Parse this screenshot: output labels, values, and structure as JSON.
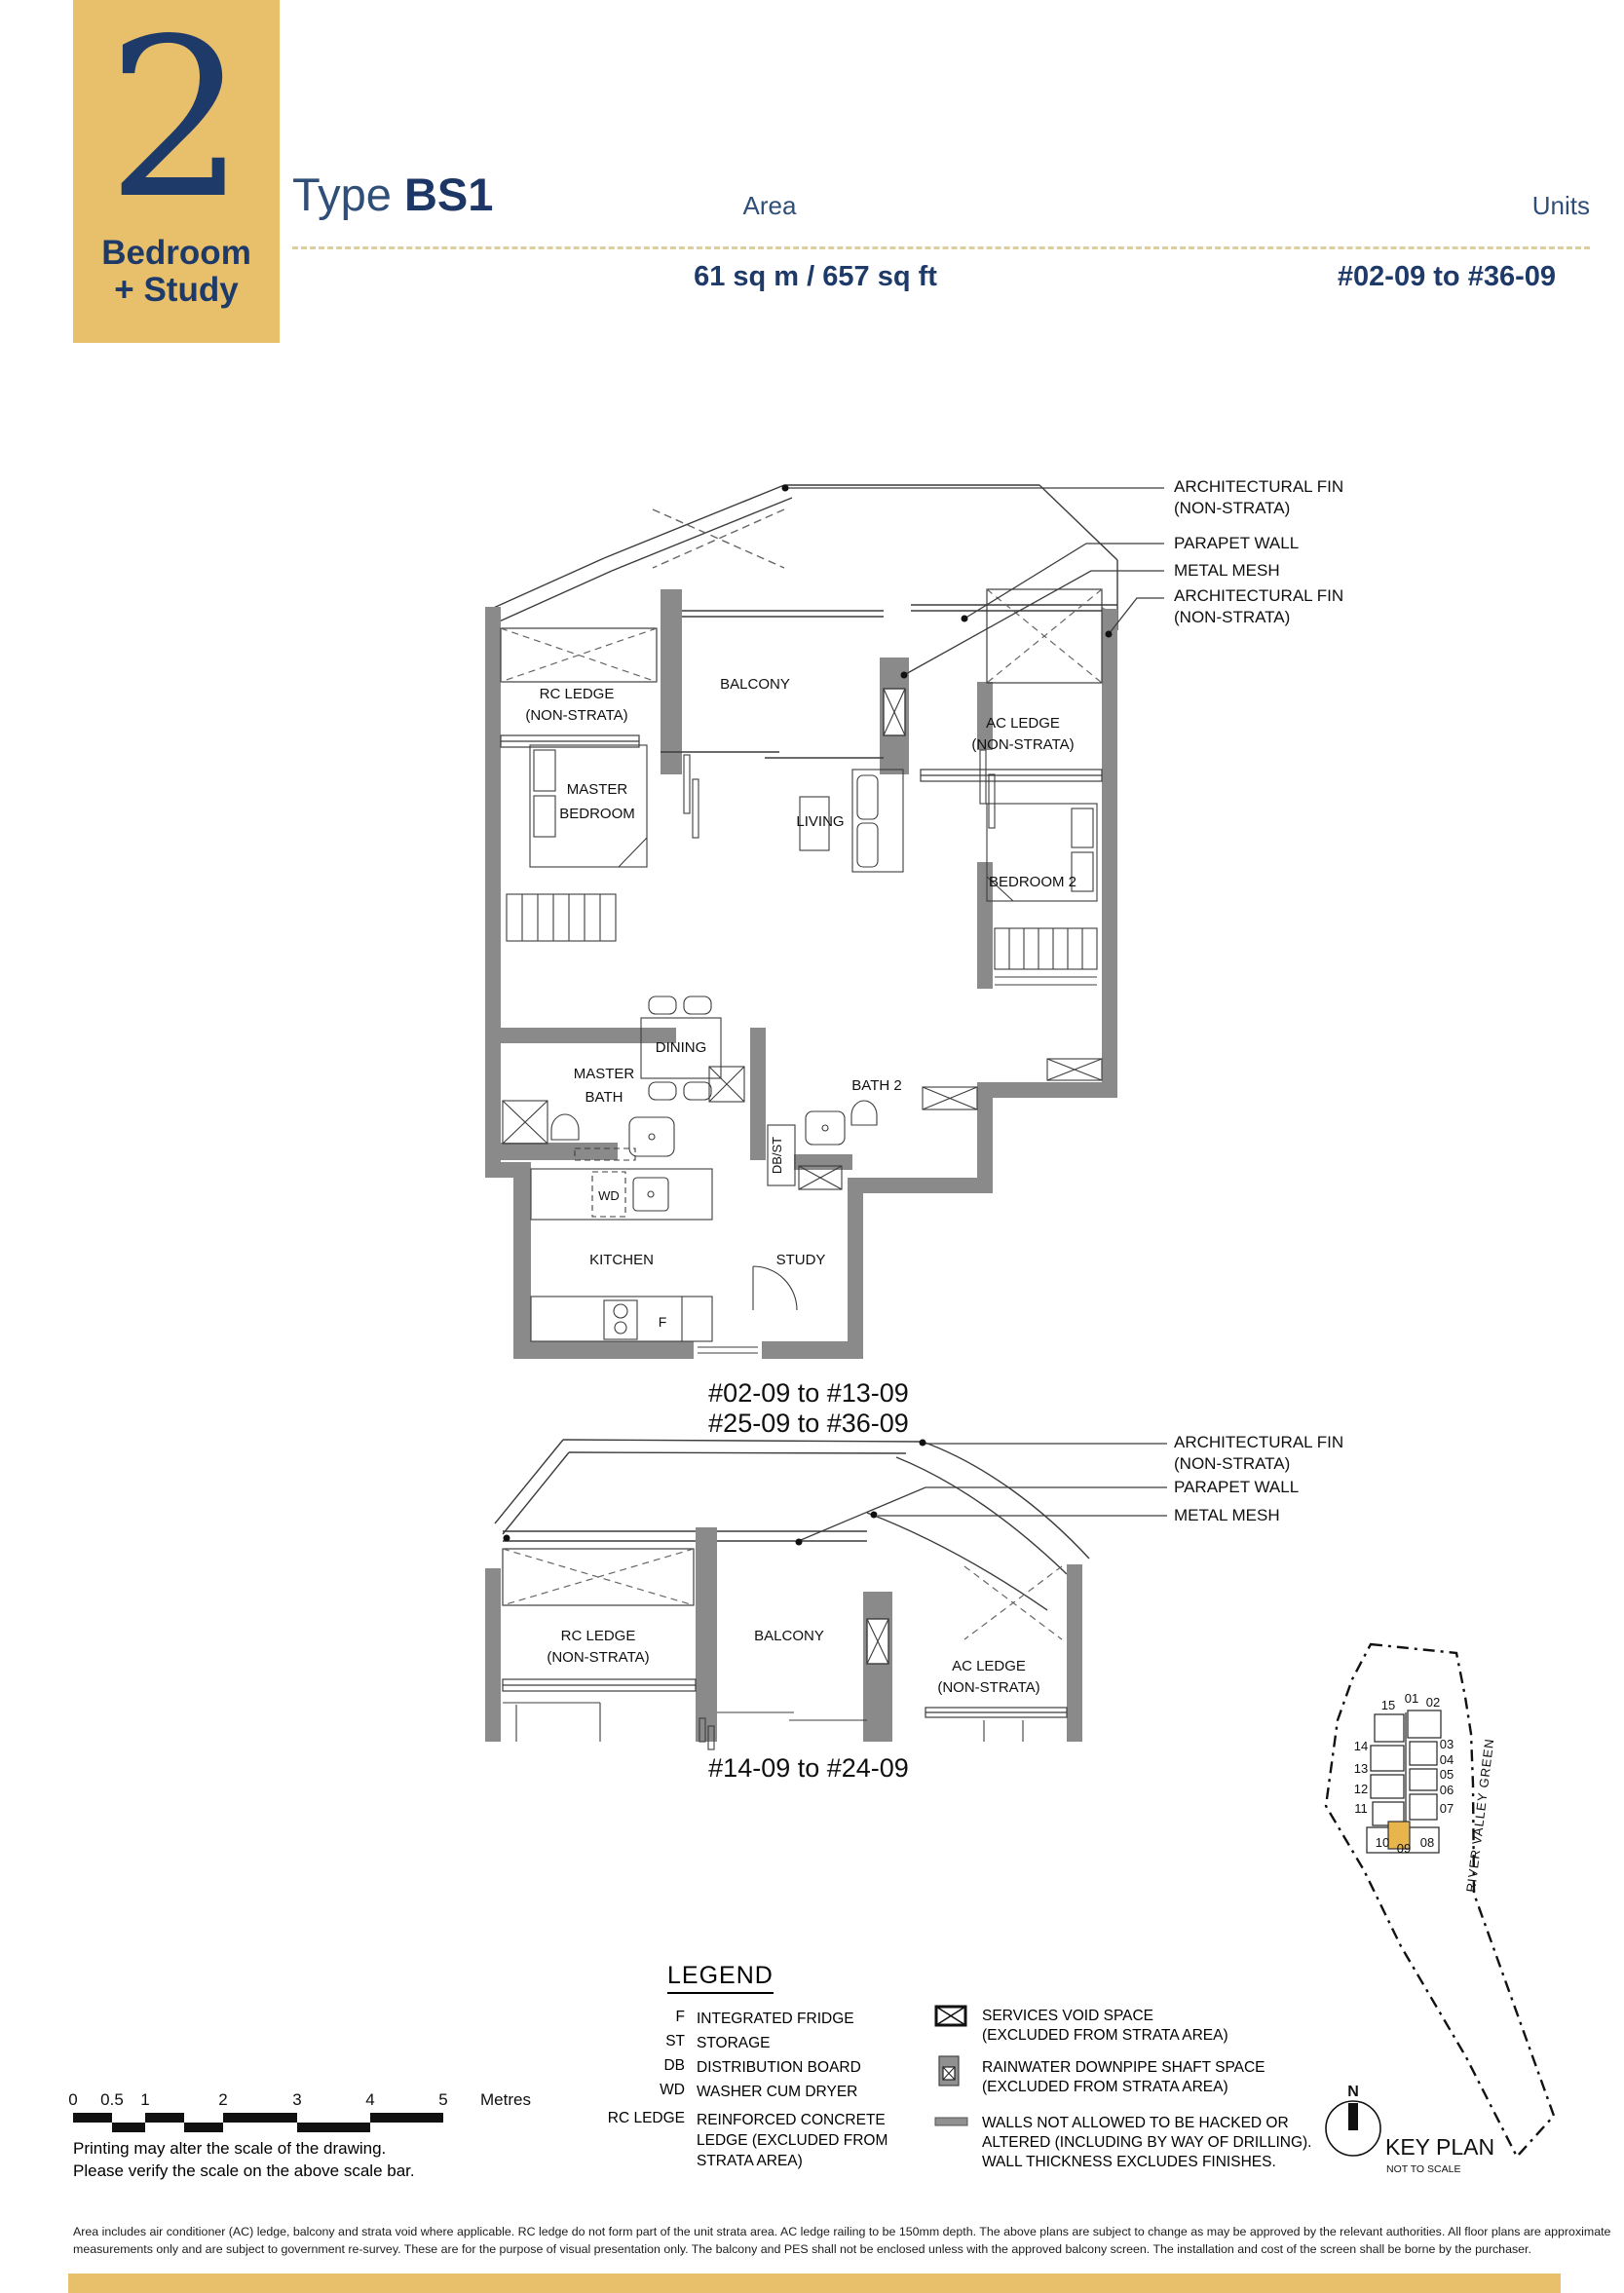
{
  "header": {
    "badge_number": "2",
    "badge_line1": "Bedroom",
    "badge_line2": "+ Study",
    "type_label": "Type ",
    "type_code": "BS1",
    "area_label": "Area",
    "units_label": "Units",
    "area_value": "61 sq m / 657 sq ft",
    "units_value": "#02-09 to #36-09"
  },
  "plan1": {
    "labels": {
      "rc_a": "RC LEDGE",
      "rc_b": "(NON-STRATA)",
      "balcony": "BALCONY",
      "ac_a": "AC LEDGE",
      "ac_b": "(NON-STRATA)",
      "mb_a": "MASTER",
      "mb_b": "BEDROOM",
      "living": "LIVING",
      "b2": "BEDROOM 2",
      "mbath_a": "MASTER",
      "mbath_b": "BATH",
      "dining": "DINING",
      "bath2": "BATH 2",
      "dbst": "DB/ST",
      "wd": "WD",
      "kitchen": "KITCHEN",
      "study": "STUDY",
      "f": "F"
    },
    "caption_line1": "#02-09 to #13-09",
    "caption_line2": "#25-09 to #36-09",
    "callouts": {
      "fin_a": "ARCHITECTURAL FIN",
      "fin_b": "(NON-STRATA)",
      "parapet": "PARAPET WALL",
      "mesh": "METAL MESH",
      "fin2_a": "ARCHITECTURAL FIN",
      "fin2_b": "(NON-STRATA)"
    }
  },
  "plan2": {
    "labels": {
      "rc_a": "RC LEDGE",
      "rc_b": "(NON-STRATA)",
      "balcony": "BALCONY",
      "ac_a": "AC LEDGE",
      "ac_b": "(NON-STRATA)"
    },
    "caption": "#14-09 to #24-09",
    "callouts": {
      "fin_a": "ARCHITECTURAL FIN",
      "fin_b": "(NON-STRATA)",
      "parapet": "PARAPET WALL",
      "mesh": "METAL MESH"
    }
  },
  "keyplan": {
    "units": [
      "15",
      "01",
      "02",
      "14",
      "03",
      "13",
      "04",
      "05",
      "12",
      "06",
      "11",
      "07",
      "10",
      "09",
      "08"
    ],
    "highlighted_unit": "09",
    "road": "RIVER VALLEY GREEN",
    "north": "N",
    "title": "KEY PLAN",
    "subtitle": "NOT TO SCALE"
  },
  "legend": {
    "title": "LEGEND",
    "left": [
      {
        "key": "F",
        "desc": "INTEGRATED FRIDGE"
      },
      {
        "key": "ST",
        "desc": "STORAGE"
      },
      {
        "key": "DB",
        "desc": "DISTRIBUTION BOARD"
      },
      {
        "key": "WD",
        "desc": "WASHER CUM DRYER"
      },
      {
        "key": "RC LEDGE",
        "desc1": "REINFORCED CONCRETE",
        "desc2": "LEDGE (EXCLUDED FROM",
        "desc3": "STRATA AREA)"
      }
    ],
    "right": [
      {
        "icon": "services-void-icon",
        "l1": "SERVICES VOID SPACE",
        "l2": "(EXCLUDED FROM STRATA AREA)"
      },
      {
        "icon": "rainwater-downpipe-icon",
        "l1": "RAINWATER DOWNPIPE SHAFT SPACE",
        "l2": "(EXCLUDED FROM STRATA AREA)"
      },
      {
        "icon": "protected-wall-icon",
        "l1": "WALLS NOT ALLOWED TO BE HACKED OR",
        "l2": "ALTERED (INCLUDING BY WAY OF DRILLING).",
        "l3": "WALL THICKNESS EXCLUDES FINISHES."
      }
    ]
  },
  "scalebar": {
    "labels": [
      "0",
      "0.5",
      "1",
      "2",
      "3",
      "4",
      "5"
    ],
    "unit": "Metres",
    "note1": "Printing may alter the scale of the drawing.",
    "note2": "Please verify the scale on the above scale bar."
  },
  "footer": {
    "line1": "Area includes air conditioner (AC) ledge, balcony and strata void where applicable. RC ledge do not form part of the unit strata area. AC ledge railing to be 150mm depth. The above plans are subject to change as may be approved by the relevant authorities. All floor plans are approximate",
    "line2": "measurements only and are subject to government re-survey. These are for the purpose of visual presentation only. The balcony and PES shall not be enclosed unless with the approved balcony screen. The installation and cost of the screen shall be borne by the purchaser."
  },
  "colors": {
    "gold": "#E8C06C",
    "navy": "#1E3A68"
  }
}
